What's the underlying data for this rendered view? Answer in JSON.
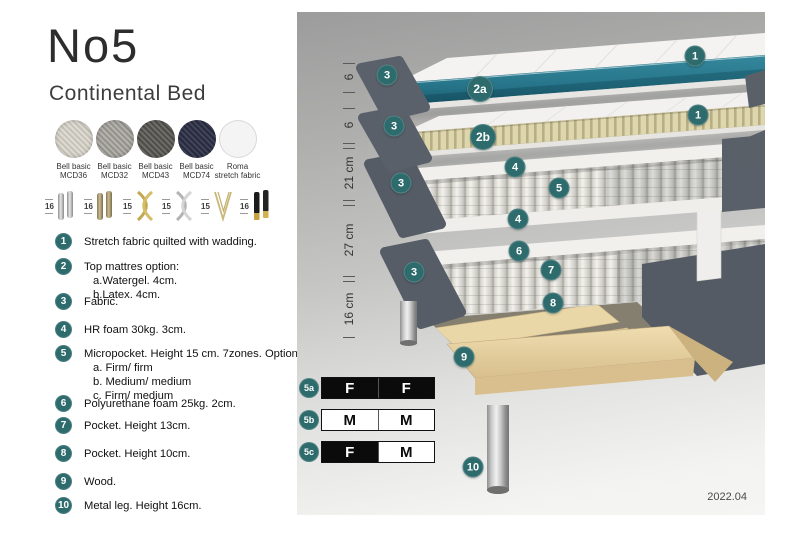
{
  "title": "No5",
  "subtitle": "Continental Bed",
  "swatches": [
    {
      "name": "Bell basic",
      "code": "MCD36"
    },
    {
      "name": "Bell basic",
      "code": "MCD32"
    },
    {
      "name": "Bell basic",
      "code": "MCD43"
    },
    {
      "name": "Bell basic",
      "code": "MCD74"
    },
    {
      "name": "Roma",
      "code": "stretch fabric"
    }
  ],
  "legs": [
    {
      "size": "16",
      "type": "cylinder-silver"
    },
    {
      "size": "16",
      "type": "cylinder-bronze"
    },
    {
      "size": "15",
      "type": "cross-gold"
    },
    {
      "size": "15",
      "type": "cross-silver"
    },
    {
      "size": "15",
      "type": "hairpin-gold"
    },
    {
      "size": "16",
      "type": "cylinder-black-gold"
    }
  ],
  "legend": [
    {
      "num": "1",
      "text": "Stretch fabric quilted with wadding."
    },
    {
      "num": "2",
      "text": "Top mattres option:",
      "sub": [
        "a.Watergel. 4cm.",
        "b.Latex. 4cm."
      ]
    },
    {
      "num": "3",
      "text": "Fabric."
    },
    {
      "num": "4",
      "text": "HR foam 30kg. 3cm."
    },
    {
      "num": "5",
      "text": "Micropocket. Height 15 cm. 7zones. Option:",
      "sub": [
        "a. Firm/ firm",
        "b. Medium/ medium",
        "c. Firm/ medium"
      ]
    },
    {
      "num": "6",
      "text": "Polyurethane foam 25kg. 2cm."
    },
    {
      "num": "7",
      "text": "Pocket. Height 13cm."
    },
    {
      "num": "8",
      "text": "Pocket. Height 10cm."
    },
    {
      "num": "9",
      "text": "Wood."
    },
    {
      "num": "10",
      "text": "Metal leg. Height 16cm."
    }
  ],
  "diagram": {
    "dimensions": [
      {
        "label": "6"
      },
      {
        "label": "6"
      },
      {
        "label": "21 cm"
      },
      {
        "label": "27 cm"
      },
      {
        "label": "16 cm"
      }
    ],
    "badges": {
      "b1": "1",
      "b2a": "2a",
      "b2b": "2b",
      "b3": "3",
      "b4": "4",
      "b5": "5",
      "b6": "6",
      "b7": "7",
      "b8": "8",
      "b9": "9",
      "b10": "10"
    },
    "date": "2022.04"
  },
  "firmness": {
    "rows": [
      {
        "id": "5a",
        "cells": [
          "F",
          "F"
        ]
      },
      {
        "id": "5b",
        "cells": [
          "M",
          "M"
        ]
      },
      {
        "id": "5c",
        "cells": [
          "F",
          "M"
        ]
      }
    ]
  },
  "colors": {
    "accent_teal": "#2e6b6d",
    "watergel_teal": "#2b7e92",
    "fabric_gray": "#5b616b",
    "latex_beige": "#ded7ad",
    "wood": "#e8d4a4"
  }
}
